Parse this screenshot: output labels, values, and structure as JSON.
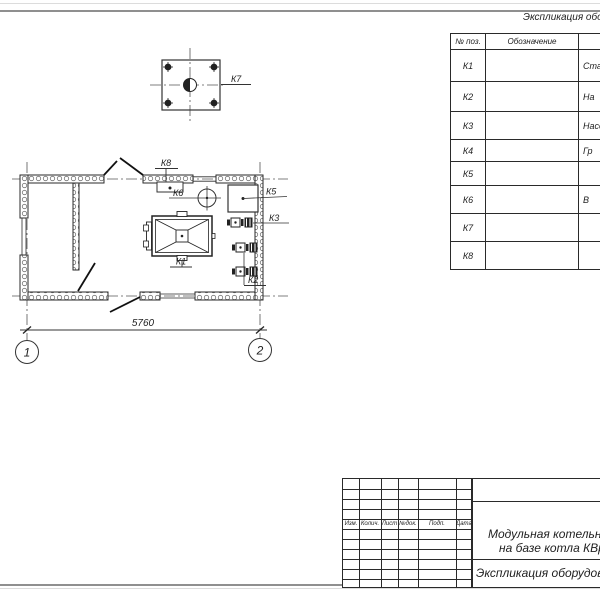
{
  "plan": {
    "k1": "К1",
    "k2": "К2",
    "k3": "К3",
    "k5": "К5",
    "k6": "К6",
    "k7": "К7",
    "k8": "К8",
    "dim_width": "5760",
    "axis_1": "1",
    "axis_2": "2"
  },
  "equip_table": {
    "caption": "Экспликация оборудования",
    "header": {
      "pos": "№ поз.",
      "designation": "Обозначение"
    },
    "rows": [
      {
        "pos": "К1",
        "designation": "",
        "name": "Стал"
      },
      {
        "pos": "К2",
        "designation": "",
        "name": "На"
      },
      {
        "pos": "К3",
        "designation": "",
        "name": "Насос"
      },
      {
        "pos": "К4",
        "designation": "",
        "name": "Гр"
      },
      {
        "pos": "К5",
        "designation": "",
        "name": ""
      },
      {
        "pos": "К6",
        "designation": "",
        "name": "В"
      },
      {
        "pos": "К7",
        "designation": "",
        "name": ""
      },
      {
        "pos": "К8",
        "designation": "",
        "name": ""
      }
    ]
  },
  "title_block": {
    "columns": [
      "Изм.",
      "Колич.",
      "Лист",
      "№док.",
      "Подп.",
      "Дата"
    ],
    "project_title_line1": "Модульная котельная",
    "project_title_line2": "на базе котла КВр",
    "sheet_title": "Экспликация оборудования"
  },
  "colors": {
    "line": "#2a2a2a",
    "centerline": "#555555",
    "page_edge": "#8f8f8f"
  }
}
